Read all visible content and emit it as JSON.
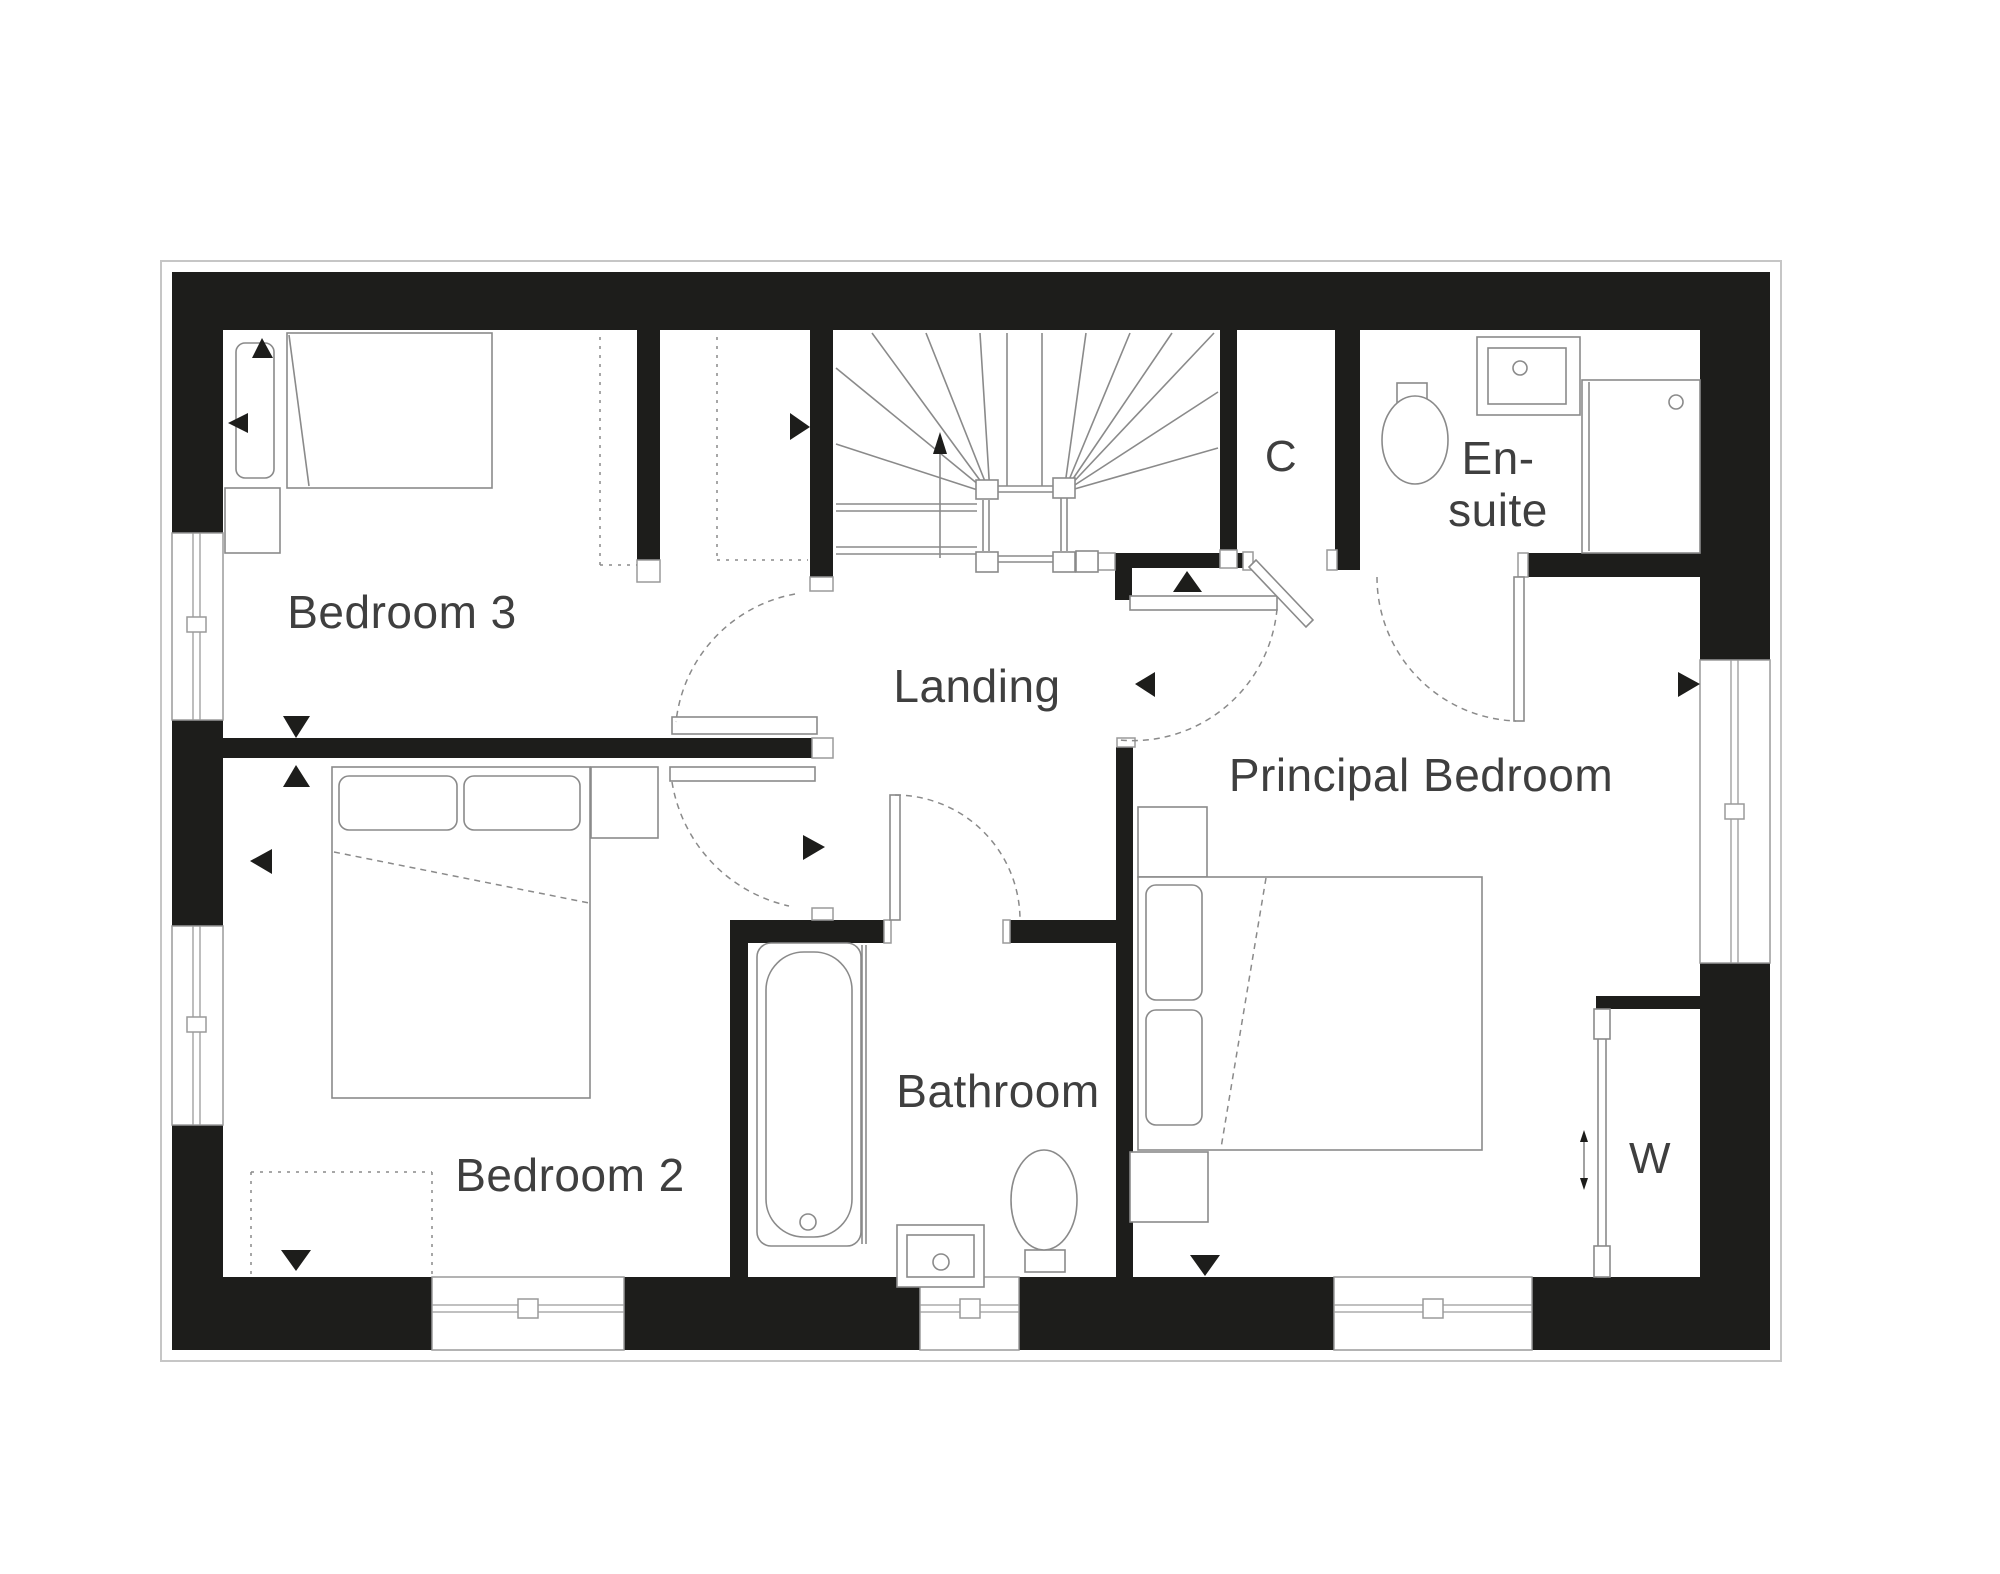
{
  "floorplan": {
    "background": "#ffffff",
    "wall_color": "#1d1d1b",
    "line_color": "#8a8a8a",
    "text_color": "#3f3f3f",
    "rooms": {
      "bedroom3": "Bedroom 3",
      "landing": "Landing",
      "cupboard": "C",
      "ensuite_line1": "En-",
      "ensuite_line2": "suite",
      "principal_bedroom": "Principal Bedroom",
      "bedroom2": "Bedroom 2",
      "bathroom": "Bathroom",
      "wardrobe": "W"
    }
  }
}
